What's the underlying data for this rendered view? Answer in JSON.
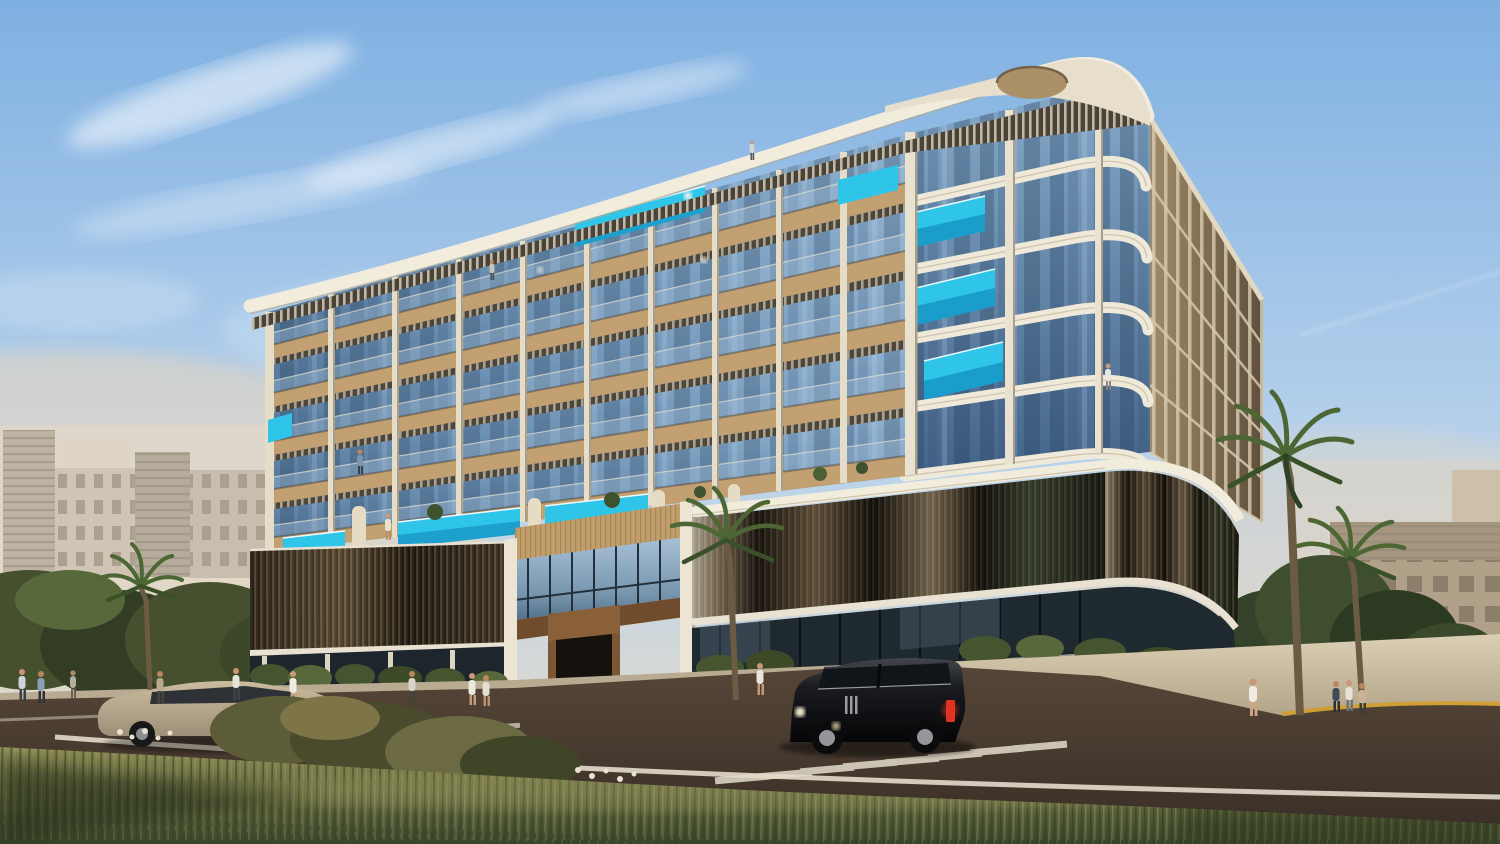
{
  "scene": {
    "type": "photorealistic-architectural-rendering",
    "subject": "modern low-rise luxury residential building on a landscaped street corner",
    "time_of_day": "late-afternoon golden hour",
    "sky": "clear blue sky with wispy cirrus clouds and a faint contrail",
    "visible_text": "none"
  },
  "palette": {
    "sky_top": "#7fb0e2",
    "sky_mid": "#b9d3ec",
    "sky_horizon": "#ecdcc6",
    "glow_warm": "#ffd9a8",
    "cloud_white": "#ffffff",
    "canopy_white": "#f2ecdc",
    "oculus_tan": "#ab9168",
    "fin_cream": "#e6ddc9",
    "wood_tan": "#c3a071",
    "entrance_wood": "#7d5634",
    "glass_blue": "#6e92b4",
    "glass_dark": "#22303a",
    "pool_cyan": "#2fc5e9",
    "pool_deep": "#0b7cb4",
    "louver_dark": "#14110d",
    "louver_bronze": "#6e5a40",
    "hedge_green": "#45552f",
    "foliage_dark": "#34422a",
    "palm_green": "#4c6634",
    "sidewalk": "#b9aa92",
    "road_light": "#5b4a3b",
    "road_dark": "#3a2f27",
    "road_marking": "#e3dccb",
    "curb_yellow": "#cf9f35",
    "grass_light": "#8f8d55",
    "grass_dark": "#39452a",
    "suv_black": "#1a1b1f",
    "suv_tail_red": "#e03522",
    "car_beige": "#cbbc9f",
    "bg_building_grey": "#a9a398",
    "bg_building_beige": "#9b8c74",
    "haze_pink": "#ecd9c2"
  },
  "main_building": {
    "floors_visible": 6,
    "features": [
      "rounded white roof canopy with circular oculus dish",
      "rooftop slatted pergola band",
      "grid of glass balconies with cream vertical fins",
      "wood-clad balcony slabs",
      "cyan balcony plunge pools",
      "rounded corner balconies with ribbed white bands",
      "amenity pool deck above podium",
      "dark bronze louvered podium",
      "double-height glass entrance with wood portal",
      "ground-floor storefront glazing"
    ]
  },
  "vehicles": [
    {
      "name": "black-suv",
      "style": "full-size luxury SUV",
      "color": "#1a1b1f",
      "detail": "red taillight, headlight glare",
      "position": "center of road"
    },
    {
      "name": "beige-hatchback",
      "style": "compact wagon",
      "color": "#cbbc9f",
      "position": "left side of road"
    }
  ],
  "people": {
    "count": 19,
    "locations": [
      "left sidewalk",
      "entrance plaza",
      "right corner crosswalk",
      "balconies",
      "amenity deck"
    ]
  },
  "vegetation": {
    "palm_trees": 5,
    "street_shrubs": "hedges and flowering bushes",
    "foreground": "tall wild grass meadow"
  },
  "road": {
    "markings": [
      "white crosswalk dashes (two groups)",
      "white road edge line",
      "white lane line (left)",
      "yellow curb line (right corner)"
    ]
  },
  "background": {
    "left": "cluster of grey/white mid-rise residential blocks in haze",
    "right": "long beige apartment slab and light tower in haze"
  }
}
